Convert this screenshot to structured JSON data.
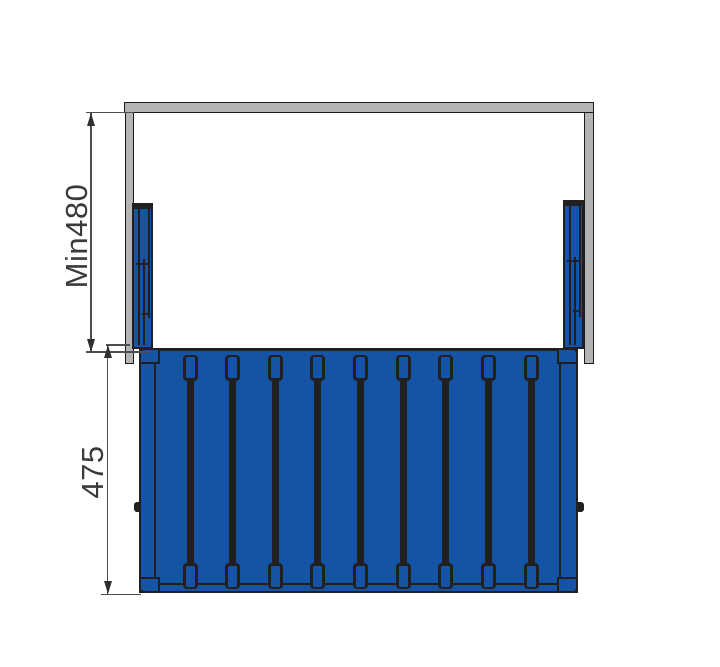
{
  "drawing": {
    "description": "Front-view technical dimension drawing of a pull-out basket mounted on telescopic slides inside a cabinet",
    "dim_inner_height": {
      "label": "Min480",
      "orientation": "vertical"
    },
    "dim_basket_height": {
      "label": "475",
      "orientation": "vertical"
    },
    "slats": {
      "count": 9
    },
    "colors": {
      "basket_blue": "#1553a5",
      "outline_dark": "#221f20",
      "rail_gray": "#b4b3b6",
      "dimension_line": "#4d4d52",
      "label_text": "#3a3a3a",
      "background": "#ffffff"
    }
  }
}
